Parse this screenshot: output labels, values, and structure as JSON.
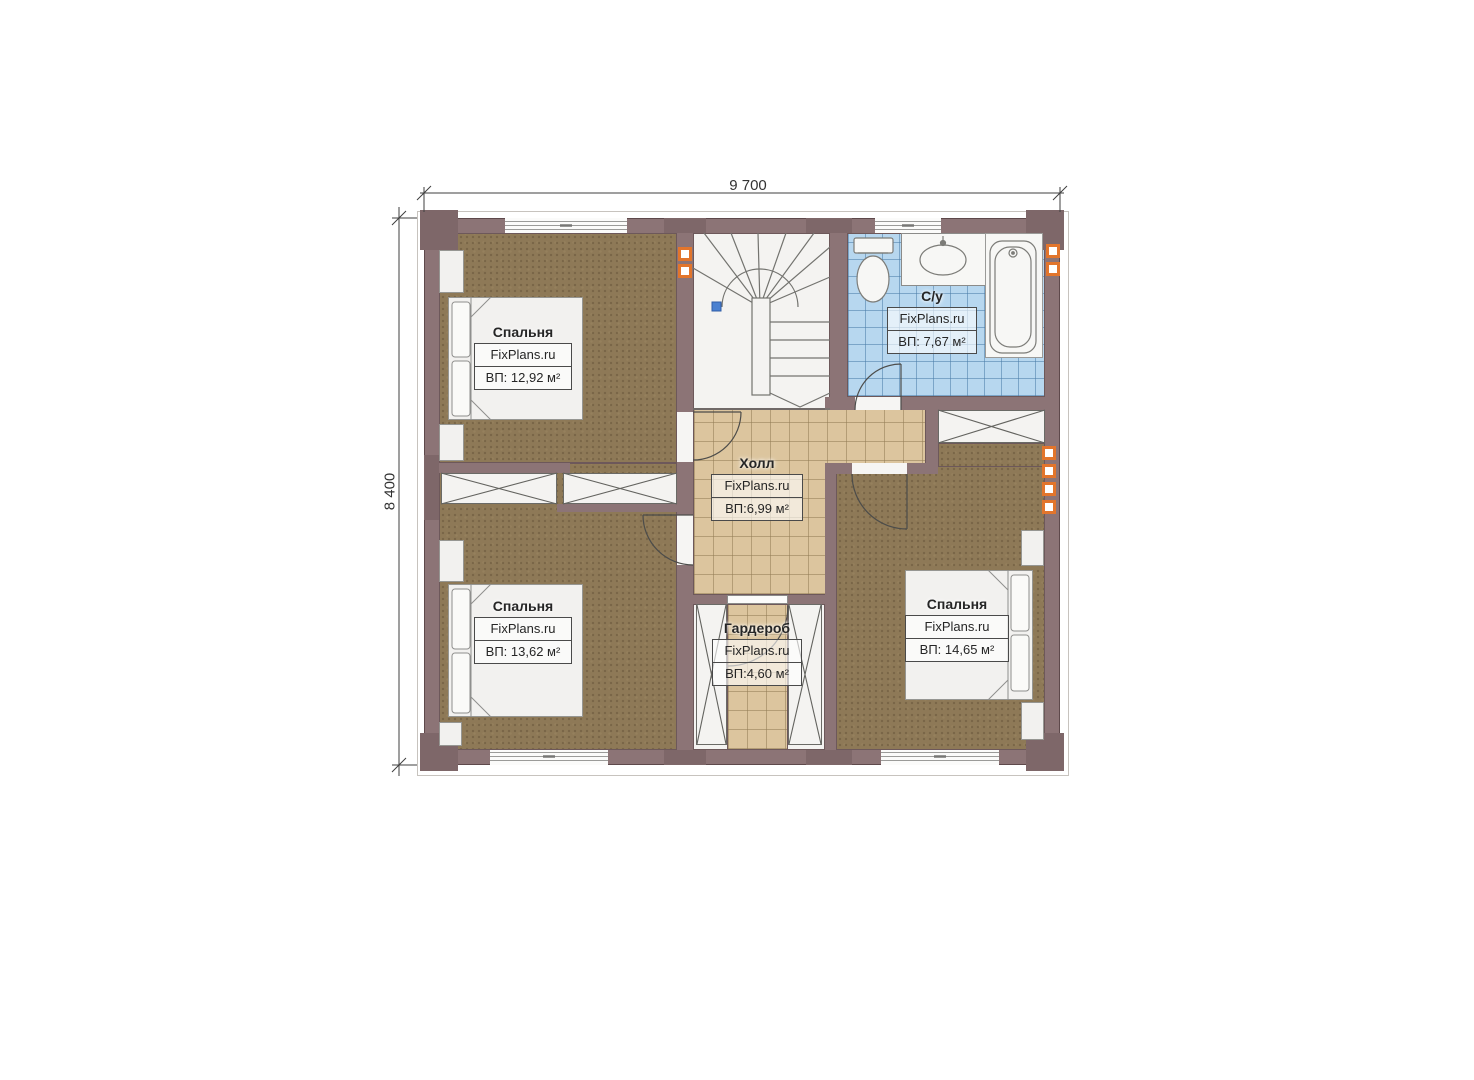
{
  "dimensions": {
    "top": "9 700",
    "left": "8 400"
  },
  "brand": "FixPlans.ru",
  "rooms": {
    "bedroom_top_left": {
      "name": "Спальня",
      "area": "ВП: 12,92 м²"
    },
    "bathroom": {
      "name": "С/у",
      "area": "ВП: 7,67 м²"
    },
    "hall": {
      "name": "Холл",
      "area": "ВП:6,99 м²"
    },
    "bedroom_bottom_left": {
      "name": "Спальня",
      "area": "ВП: 13,62 м²"
    },
    "wardrobe": {
      "name": "Гардероб",
      "area": "ВП:4,60 м²"
    },
    "bedroom_bottom_right": {
      "name": "Спальня",
      "area": "ВП: 14,65 м²"
    }
  },
  "colors": {
    "wall": "#8c7476",
    "wall_dark": "#7e6769",
    "bedroom_floor": "#8e7957",
    "hall_floor": "#dcc59e",
    "bathroom_floor": "#b7d7ef",
    "vent_orange": "#e2752c",
    "stair_marker_blue": "#4a80d0"
  }
}
